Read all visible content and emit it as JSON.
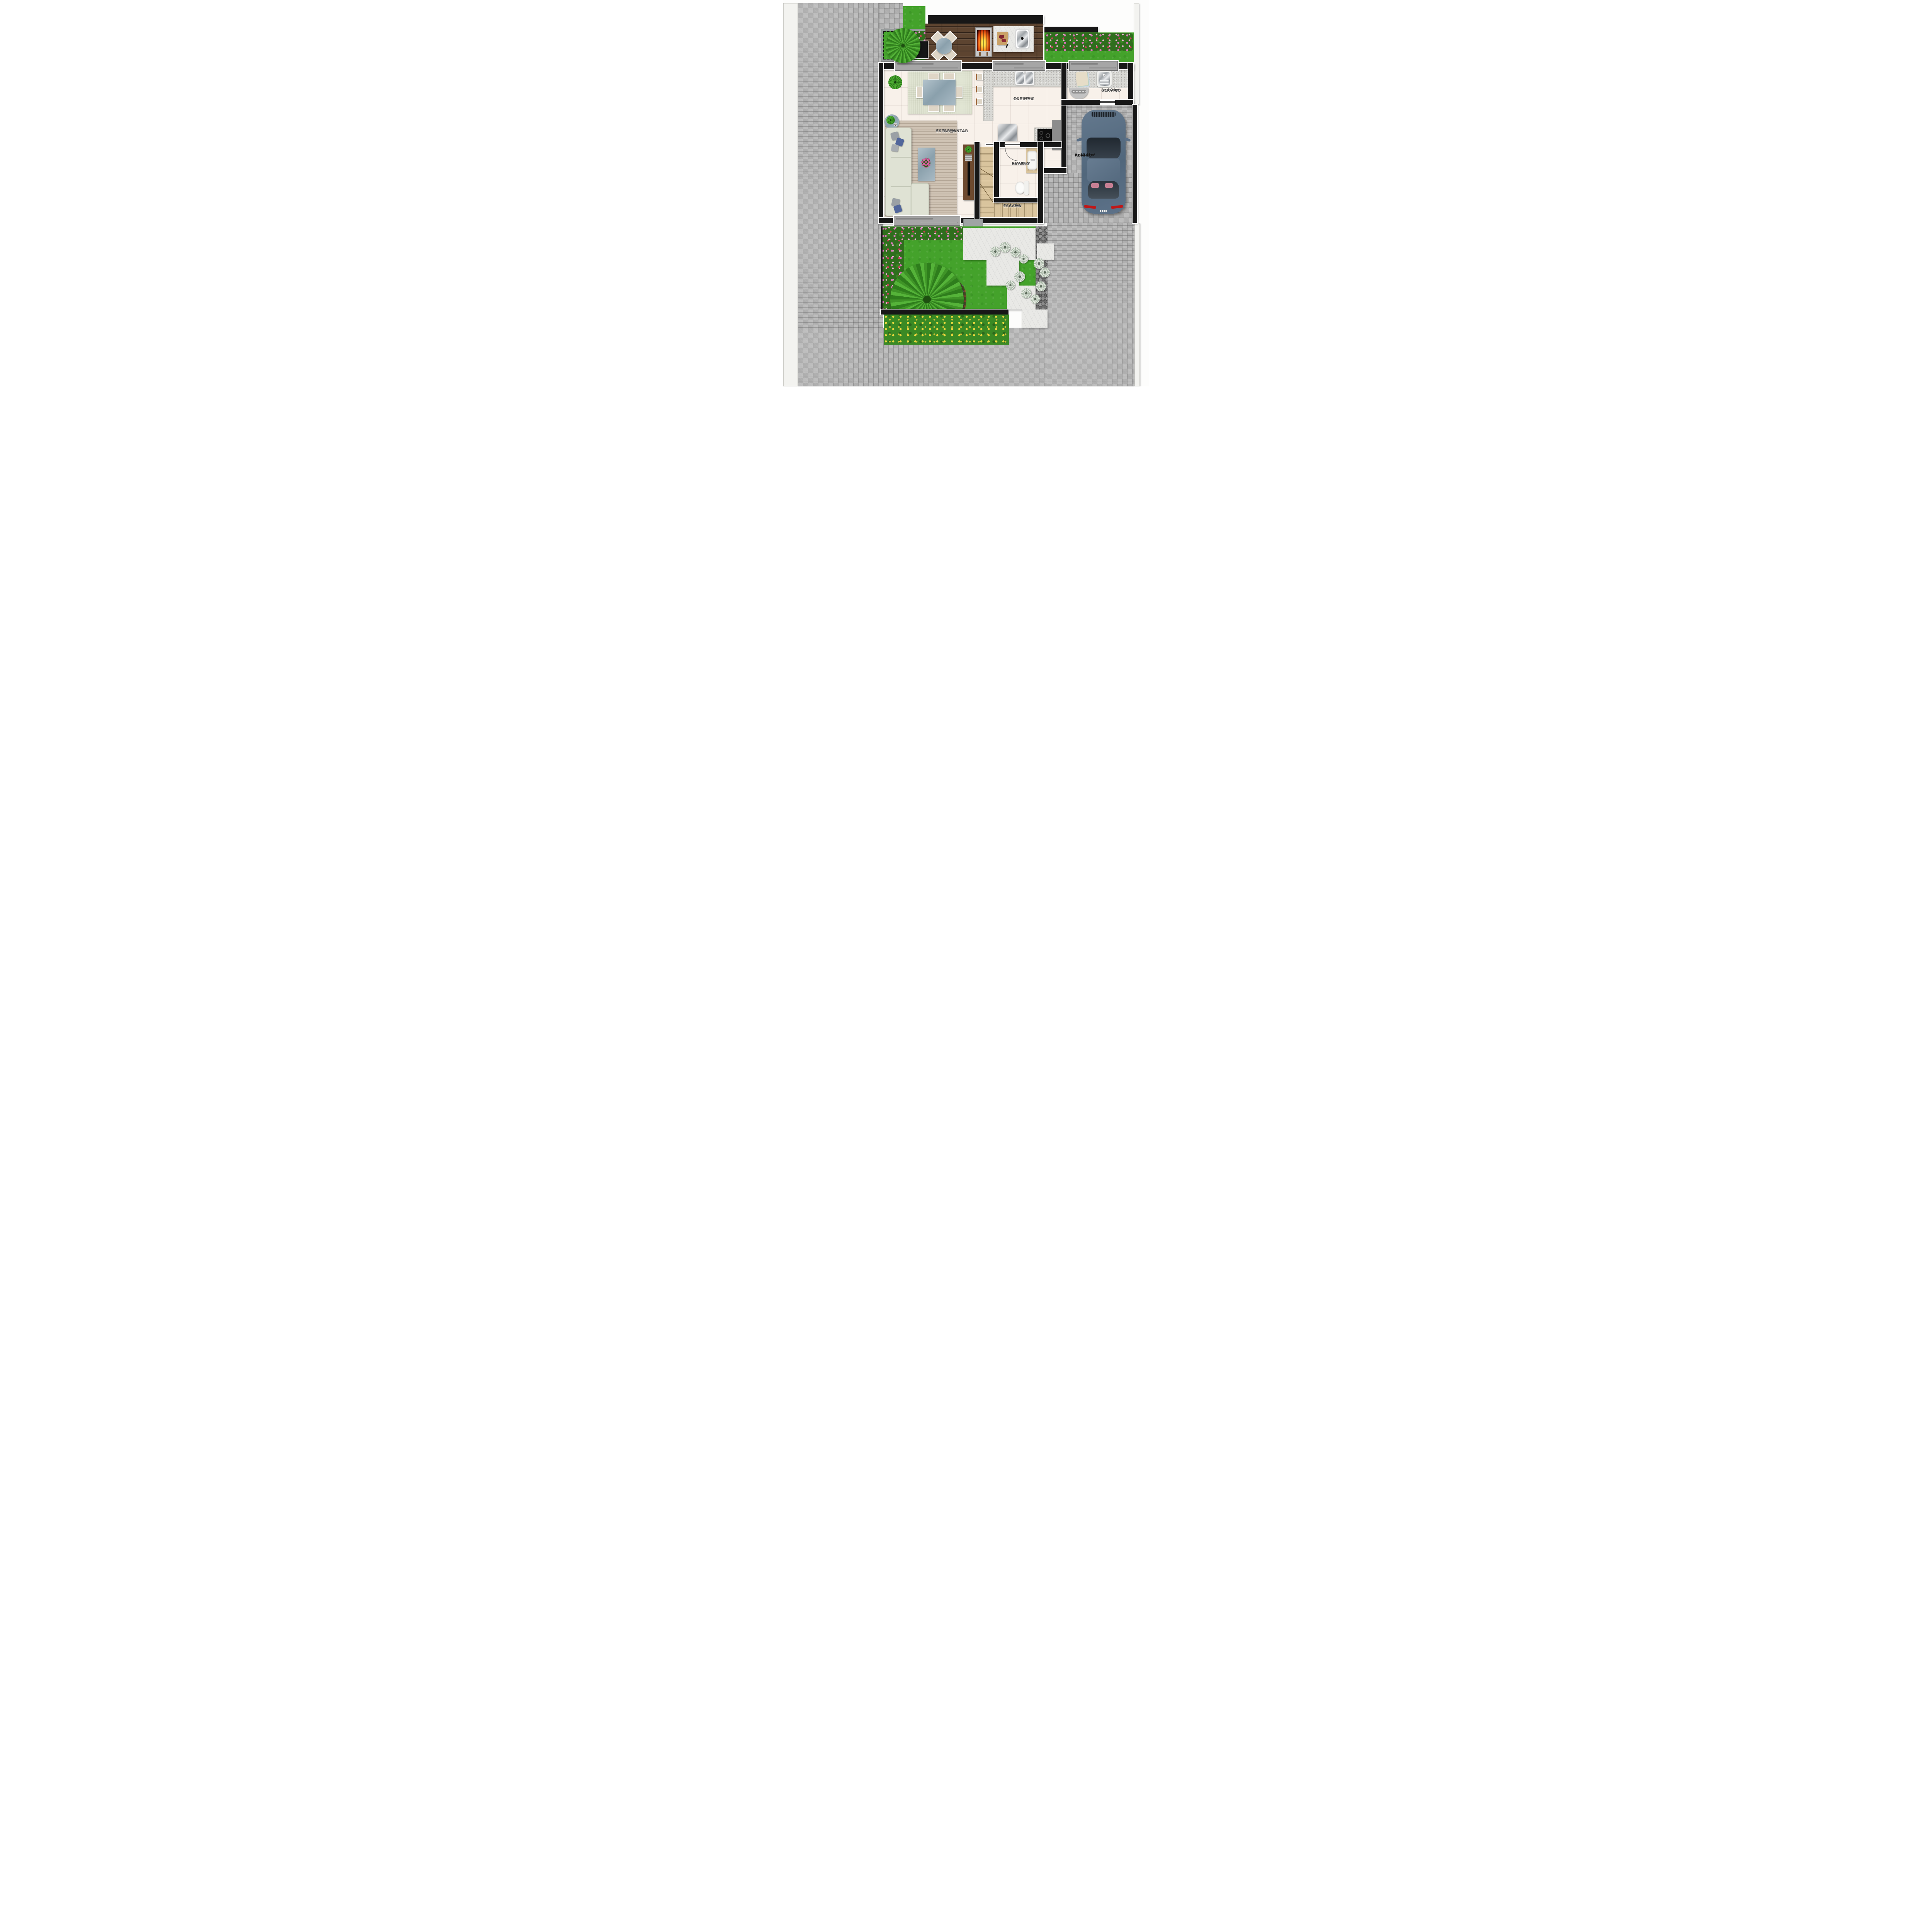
{
  "plan": {
    "type": "residential-ground-floor-plan",
    "language": "pt-BR",
    "view": "top-down rendered site plan"
  },
  "rooms": {
    "estar": {
      "name": "ESTAR/JANTAR",
      "area": "A= 20,19m²"
    },
    "cozinha": {
      "name": "COZINHA",
      "area": "A= 10,49m²"
    },
    "servico": {
      "name": "SERVIÇO",
      "area": "A= 3,24m²"
    },
    "lavabo": {
      "name": "LAVABO",
      "area": "A= 2,40m²"
    },
    "escada": {
      "name": "ESCADA",
      "area": "A= 4,26m²"
    },
    "abrigo": {
      "name": "ABRIGO",
      "area": "A= 13,29m²"
    }
  },
  "outdoor_features": [
    "paved-sidewalk-left",
    "paved-driveway-right",
    "wood-deck-with-barbecue",
    "planter-bed-with-palm",
    "rear-lawn-with-flower-hedge",
    "front-garden-lawn",
    "marble-stepping-stones",
    "river-rock-strip",
    "yellow-flower-bed",
    "boundary-walls"
  ],
  "furniture_and_fixtures": {
    "estar": [
      "l-shaped-sofa",
      "striped-rug",
      "glass-coffee-table-with-flowers",
      "round-side-table",
      "dining-table-6-chairs",
      "linen-rug",
      "potted-plant",
      "tv-panel-cabinet"
    ],
    "cozinha": [
      "l-shaped-granite-counter",
      "double-bowl-sink",
      "three-bar-stools",
      "stainless-refrigerator",
      "granite-island",
      "black-cooktop",
      "tall-gray-cabinet"
    ],
    "servico": [
      "granite-laundry-counter",
      "folded-towels",
      "laundry-tub-sink",
      "top-load-washing-machine"
    ],
    "lavabo": [
      "marble-vanity-with-basin",
      "toilet"
    ],
    "escada": [
      "winder-staircase-beige-stone"
    ],
    "abrigo": [
      "blue-gray-car-top-view"
    ],
    "deck": [
      "round-glass-table-4-chairs",
      "charcoal-barbecue-grill",
      "marble-counter-with-sink",
      "cutting-board-with-meat-and-knife"
    ]
  },
  "colors": {
    "grass": "#44a22b",
    "deck_wood": "#5d4430",
    "pavers": "#b6b6b6",
    "walls": "#171717",
    "interior_tile": "#f8f1ea",
    "granite": "#d8d8d4",
    "stair_stone": "#d9c49d",
    "marble_path": "#e9e9e6",
    "car_body": "#5d7289",
    "label_text": "#3e3e3e"
  }
}
